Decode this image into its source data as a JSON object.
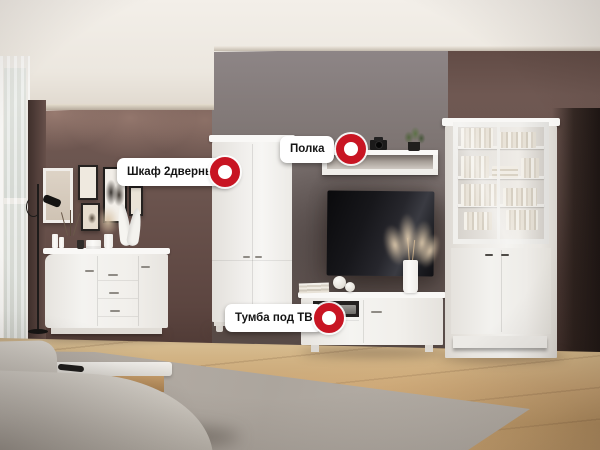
{
  "annotations": {
    "wardrobe": {
      "label": "Шкаф 2дверный"
    },
    "shelf": {
      "label": "Полка"
    },
    "tv_stand": {
      "label": "Тумба под ТВ"
    }
  },
  "colors": {
    "hotspot_red": "#c81523",
    "label_background": "#ffffff",
    "label_text": "#141414",
    "wall_brown": "#6b544e",
    "alcove_gray": "#7f7674",
    "ceiling": "#efeae2",
    "floor_wood": "#c7a374",
    "rug_gray": "#b1aaa2",
    "furniture_white": "#f2f1ed",
    "tv_black": "#15151a"
  }
}
